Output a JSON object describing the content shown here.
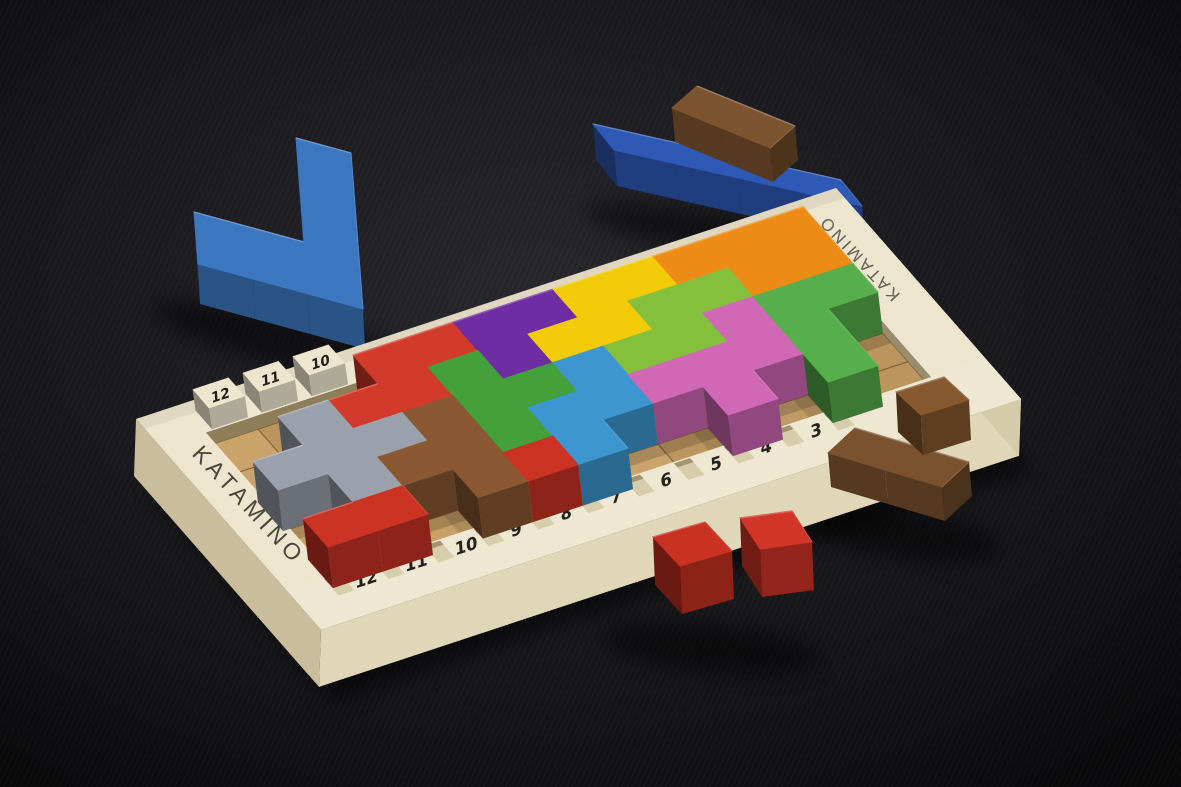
{
  "scene": {
    "type": "photograph",
    "description": "Katamino wooden pentomino puzzle game photographed on a dark charcoal background: a cream wooden board with a 12x5 recessed grid holds brightly colored interlocking pentomino blocks; both rails are notched and numbered; loose pieces (blue V, royal blue bar, brown blocks and cubes, red cubes) lie around the board.",
    "background_center": "#26262b",
    "background_edge": "#0d0d10"
  },
  "board": {
    "brand_left": "KATAMINO",
    "brand_right": "KATAMINO",
    "brand_color": "#49453b",
    "frame_color": "#ede5cd",
    "frame_front_color": "#e0d6b8",
    "frame_left_color": "#c9bd9c",
    "frame_right_color": "#d5caa9",
    "recess_wall_color": "#8d7d58",
    "wood_color": "#c89f64",
    "grid_line_color": "#3f2e1b",
    "number_color": "#24211b",
    "notch_color": "#d8cdaa",
    "notch_shadow_color": "#a2946e",
    "grid_cols": 12,
    "grid_rows": 5,
    "near_rail_numbers": [
      "12",
      "11",
      "10",
      "9",
      "8",
      "7",
      "6",
      "5",
      "4",
      "3"
    ],
    "far_rail_numbers": [
      "12",
      "11",
      "10"
    ]
  },
  "pieces": {
    "layout_rows": [
      "WWWRRUUYYOOO",
      "WGRRNUYYLLOO",
      "GGGBNNSLLMEE",
      "WGBBNSSMMMEW",
      "KKWBKSWWMWEW"
    ],
    "palette": {
      "R": {
        "name": "red-pentomino",
        "color": "#d23a2b"
      },
      "K": {
        "name": "red-cubes-on-board",
        "color": "#cb3425"
      },
      "U": {
        "name": "purple-pentomino",
        "color": "#6e2da3"
      },
      "Y": {
        "name": "yellow-pentomino",
        "color": "#f2cb08"
      },
      "O": {
        "name": "orange-pentomino",
        "color": "#ec8c17"
      },
      "N": {
        "name": "green-pentomino",
        "color": "#44a03b"
      },
      "L": {
        "name": "lime-pentomino",
        "color": "#85c03d"
      },
      "E": {
        "name": "green-right-pentomino",
        "color": "#57ae4c"
      },
      "S": {
        "name": "sky-blue-pentomino",
        "color": "#3e96d0"
      },
      "M": {
        "name": "pink-pentomino",
        "color": "#d068b6"
      },
      "B": {
        "name": "brown-pentomino",
        "color": "#8a5833"
      },
      "G": {
        "name": "gray-pentomino",
        "color": "#9aa1ac"
      }
    }
  },
  "loose_pieces": [
    {
      "name": "blue-v-pentomino",
      "color": "#3c77c0",
      "cells": [
        [
          0,
          0
        ],
        [
          1,
          0
        ],
        [
          2,
          0
        ],
        [
          2,
          -1
        ],
        [
          2,
          -2
        ]
      ]
    },
    {
      "name": "royal-blue-bar",
      "color": "#2e59b5",
      "cells": [
        [
          0,
          0
        ],
        [
          1,
          0
        ],
        [
          2,
          0
        ],
        [
          3,
          0
        ]
      ]
    },
    {
      "name": "brown-block-on-bar",
      "color": "#7d5430",
      "cells": [
        [
          0,
          0
        ],
        [
          1,
          0
        ]
      ]
    },
    {
      "name": "brown-block-right",
      "color": "#7a5230",
      "cells": [
        [
          0,
          0
        ],
        [
          1,
          0
        ]
      ]
    },
    {
      "name": "brown-cube-right",
      "color": "#86592f",
      "cells": [
        [
          0,
          0
        ]
      ]
    },
    {
      "name": "red-cube-front-left",
      "color": "#c93222",
      "cells": [
        [
          0,
          0
        ]
      ]
    },
    {
      "name": "red-cube-front-right",
      "color": "#d23628",
      "cells": [
        [
          0,
          0
        ]
      ]
    }
  ]
}
